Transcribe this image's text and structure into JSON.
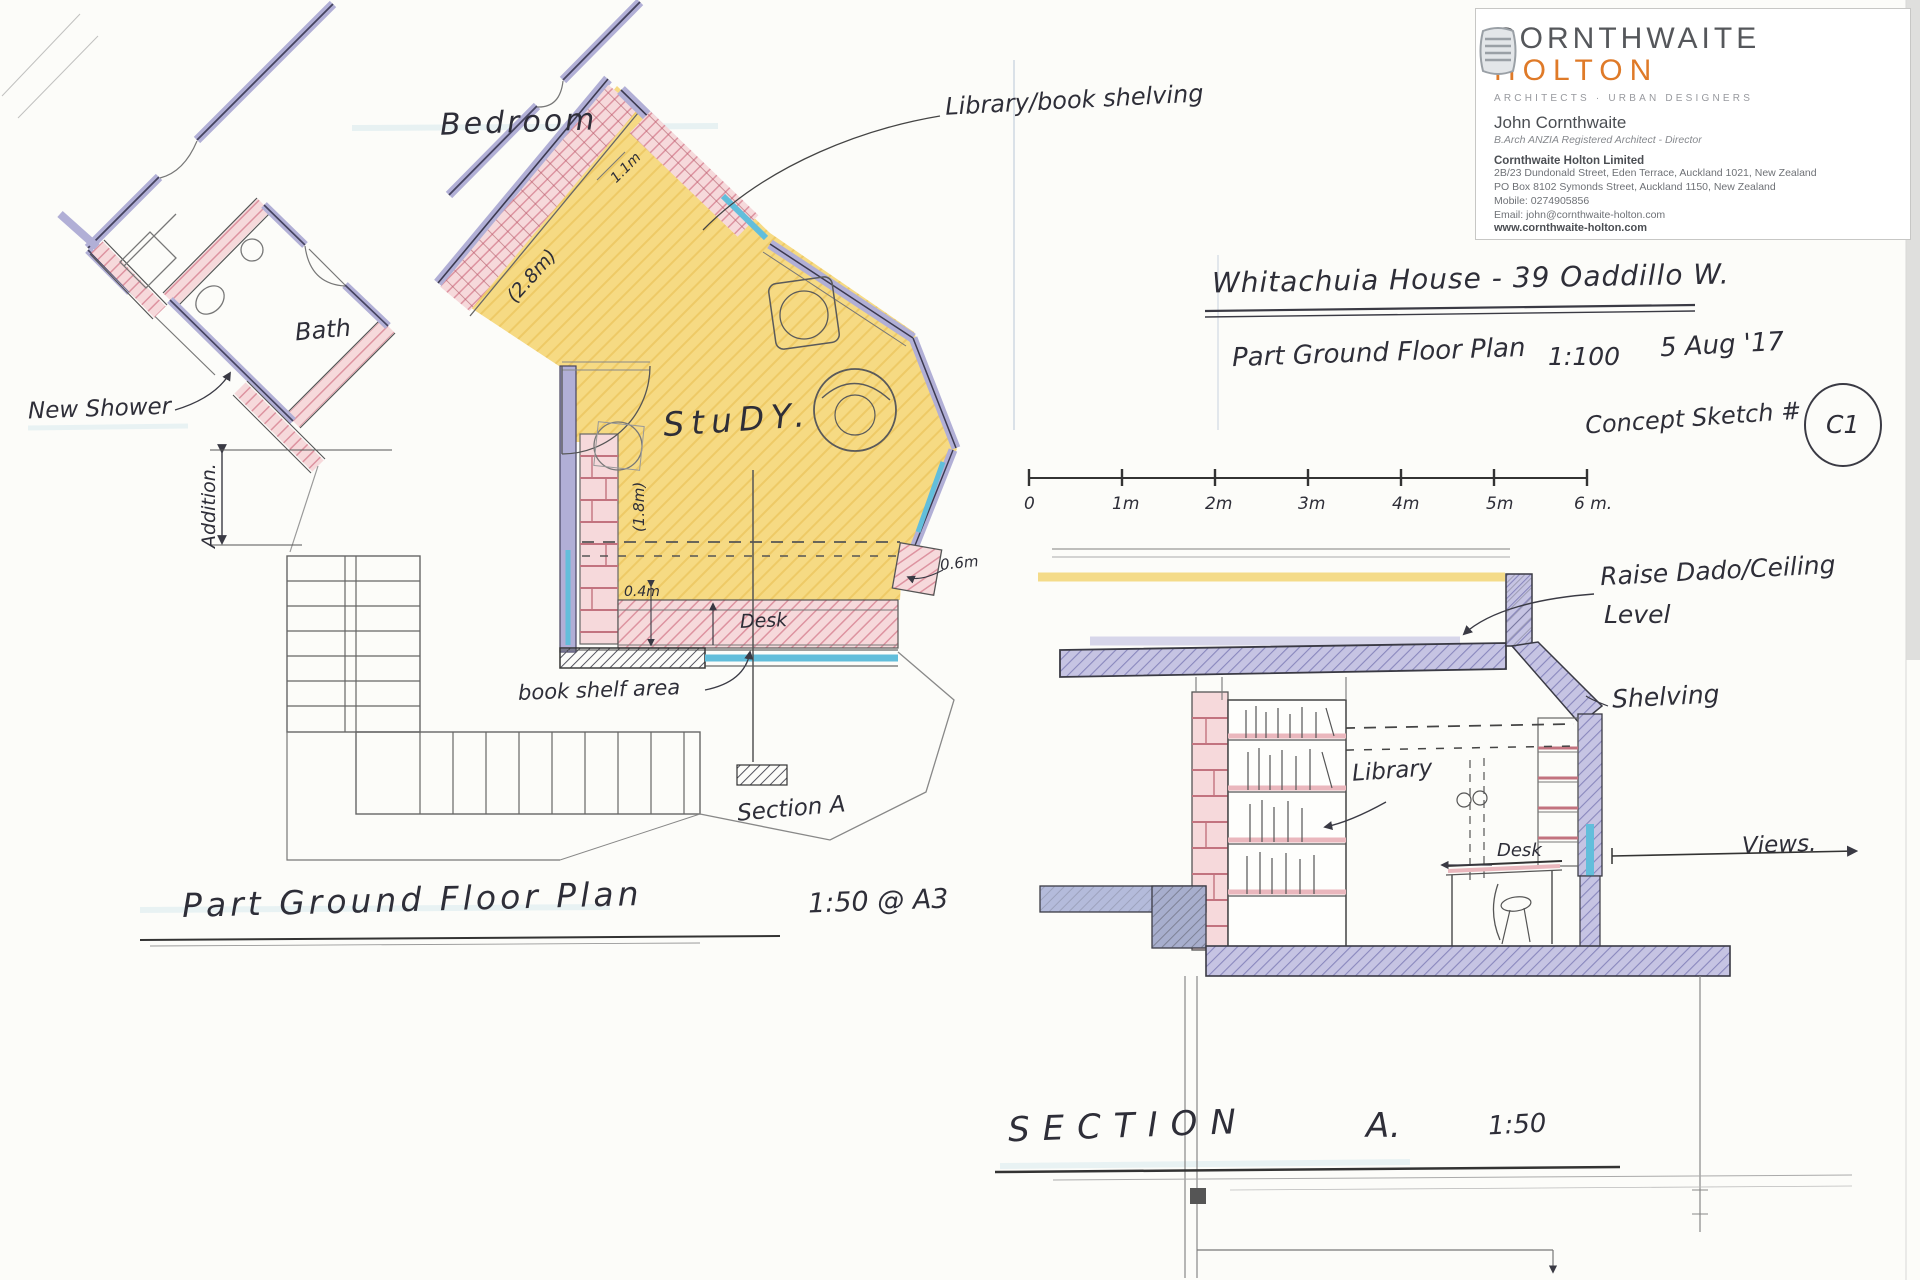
{
  "letterhead": {
    "firm_name_1": "CORNTHWAITE",
    "firm_name_2": "HOLTON",
    "tagline": "ARCHITECTS · URBAN DESIGNERS",
    "person_name": "John Cornthwaite",
    "person_title": "B.Arch ANZIA Registered Architect - Director",
    "company_name": "Cornthwaite Holton Limited",
    "address_line1": "2B/23 Dundonald Street, Eden Terrace, Auckland 1021, New Zealand",
    "address_line2": "PO Box 8102 Symonds Street, Auckland 1150, New Zealand",
    "mobile": "Mobile: 0274905856",
    "email": "Email: john@cornthwaite-holton.com",
    "website": "www.cornthwaite-holton.com",
    "brand_colors": {
      "name_gray": "#55575b",
      "name_orange": "#df7a28"
    }
  },
  "header_notes": {
    "project_title": "Whitachuia House  -  39 Oaddillo W.",
    "drawing_name": "Part Ground Floor Plan",
    "drawing_scale": "1:100",
    "date": "5 Aug '17",
    "sketch_label": "Concept Sketch #",
    "sketch_number": "C1"
  },
  "scale_bar": {
    "labels": [
      "0",
      "1m",
      "2m",
      "3m",
      "4m",
      "5m",
      "6 m."
    ]
  },
  "floor_plan": {
    "title": "Part Ground Floor Plan",
    "scale_note": "1:50 @ A3",
    "room_labels": {
      "bedroom": "Bedroom",
      "bath": "Bath",
      "study": "StuDY.",
      "new_shower": "New Shower"
    },
    "annotations": {
      "library_shelving": "Library/book shelving",
      "book_shelf_area": "book shelf area",
      "desk": "Desk",
      "section_marker": "Section A",
      "addition": "Addition."
    },
    "dimensions": {
      "wall_28": "(2.8m)",
      "shelf_18": "(1.8m)",
      "top_11": "1.1m",
      "desk_04": "0.4m",
      "right_06": "0.6m"
    }
  },
  "section": {
    "title": "SECTION",
    "title_suffix": "A.",
    "scale_note": "1:50",
    "annotations": {
      "raise_dado_1": "Raise Dado/Ceiling",
      "raise_dado_2": "Level",
      "shelving": "Shelving",
      "library": "Library",
      "desk": "Desk",
      "views": "Views."
    }
  }
}
